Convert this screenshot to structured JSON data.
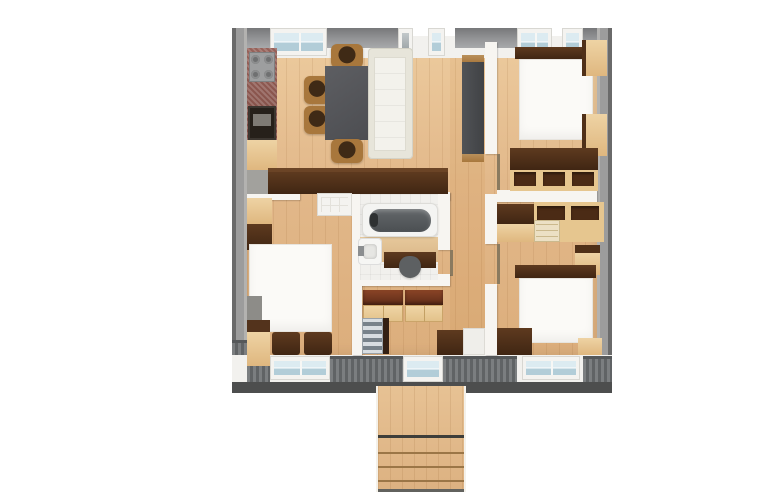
{
  "app": {
    "title": "3D apartment floor plan, top-down render on white background"
  },
  "canvas": {
    "width": 781,
    "height": 502,
    "background": "#ffffff"
  },
  "palette": {
    "exterior_wall_gray": "#9c9c9c",
    "exterior_wall_edge": "#6a6a6a",
    "top_wall_gray": "#949597",
    "interior_wall_white": "#f7f5f1",
    "floor_wood_light": "#ecca9d",
    "floor_wood_mid": "#e2b88a",
    "dark_wood_furniture": "#402613",
    "light_wood_furniture": "#dfb77f",
    "white_furniture": "#fbfaf7",
    "sofa_cream": "#e7e5da",
    "dining_table_gray": "#4c4d51",
    "kitchen_counter_red": "#96625a",
    "appliance_black": "#26201a",
    "window_glass_blue": "#dcebf1",
    "window_glass_blue_dark": "#b2cdd8",
    "bathtub_interior_gray": "#4b4f52",
    "bathroom_tile_white": "#f1f0ed",
    "ribbed_panel_gray": "#7b7e80",
    "base_strip_dark": "#4d4e4e",
    "stair_tread_light": "#d8dde1",
    "stair_tread_dark": "#78828a",
    "cabinet_top_redbrown": "#8a4426",
    "porch_wood": "#e7c294"
  },
  "rooms": {
    "living_kitchen": {
      "label": "open-plan kitchen and living room with dining set and sofa"
    },
    "hallway": {
      "label": "central hallway"
    },
    "bedroom_top_right": {
      "label": "bedroom with double bed, wardrobes and desk"
    },
    "bedroom_bottom_left": {
      "label": "bedroom with double bed, wardrobe and desk chairs"
    },
    "bedroom_bottom_right": {
      "label": "bedroom with double bed and shelving row"
    },
    "bathroom": {
      "label": "bathroom with bathtub, washbasin and toilet"
    },
    "entry": {
      "label": "entry hall with storage cabinets and internal staircase"
    },
    "porch": {
      "label": "entrance porch deck with steps"
    }
  },
  "furniture": {
    "kitchen": [
      "four-burner-cooktop",
      "red-stone-countertop",
      "oven",
      "base-cabinet",
      "gray-floor-mat"
    ],
    "living": [
      "gray-dining-table",
      "wooden-chair-top",
      "wooden-chair-left-1",
      "wooden-chair-left-2",
      "wooden-chair-bottom",
      "cream-sofa",
      "tv-cabinet-dark",
      "wardrobe-row-dark"
    ],
    "bedroom_top_right": [
      "dark-headboard",
      "white-double-bed",
      "wardrobe-block-upper",
      "wardrobe-block-lower",
      "desk-dark-top",
      "desk-cubbies"
    ],
    "bedroom_bottom_left": [
      "corner-wardrobe-light",
      "corner-wardrobe-dark",
      "white-dresser",
      "white-double-bed",
      "gray-nightstand",
      "wood-nightstand",
      "desk-chair-1",
      "desk-chair-2"
    ],
    "bedroom_bottom_right": [
      "shelf-dark-top",
      "shelf-light-front",
      "shelf-right-unit",
      "small-drawer-unit",
      "dark-headboard",
      "white-double-bed",
      "nightstand",
      "dark-wardrobe",
      "wood-bench"
    ],
    "bathroom": [
      "bathtub",
      "washbasin",
      "toilet",
      "dark-bath-mat",
      "wood-floor-strip"
    ],
    "entry": [
      "storage-cabinet-left",
      "storage-cabinet-right",
      "internal-staircase",
      "stair-railing",
      "dark-door-mat",
      "vestibule-door-leaf"
    ]
  },
  "openings": {
    "top_windows": 5,
    "bottom_windows": 2,
    "entrance_door": 1,
    "interior_door_leaves": 3,
    "porch_steps": 4
  }
}
